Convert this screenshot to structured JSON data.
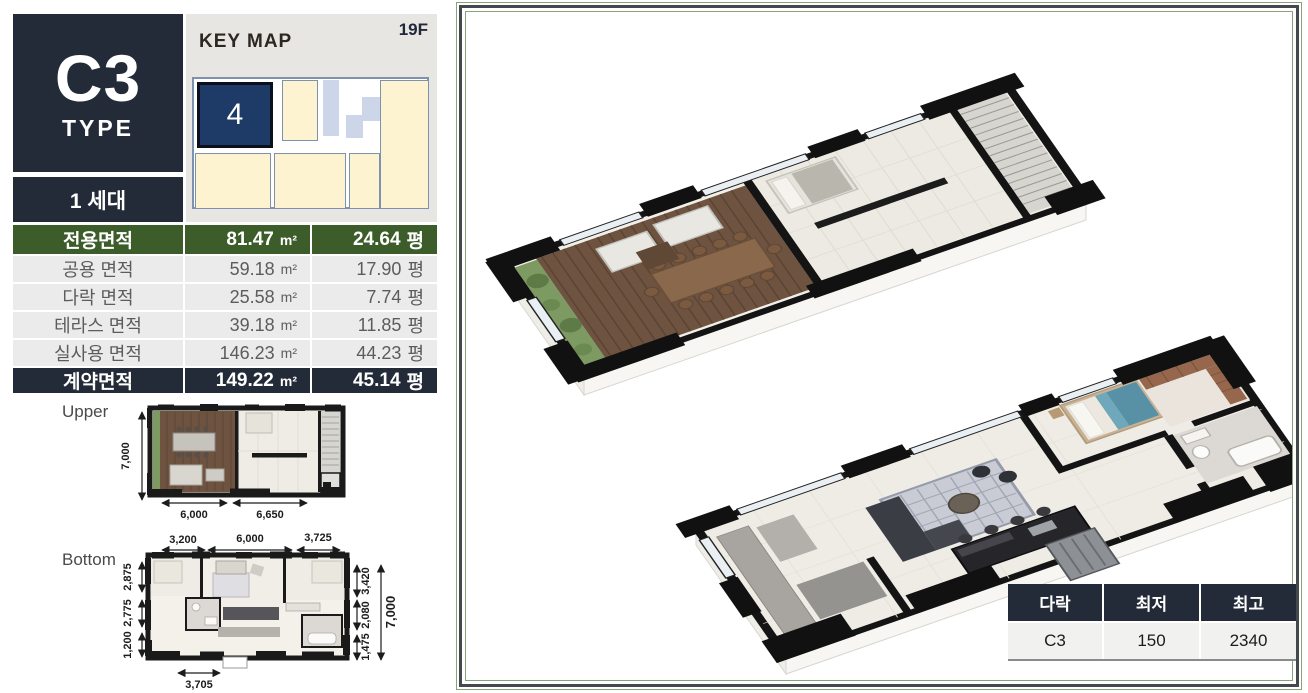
{
  "unit": {
    "type": "C3",
    "type_label": "TYPE",
    "household": "1 세대"
  },
  "keymap": {
    "title": "KEY MAP",
    "floor": "19F",
    "unit_number": "4"
  },
  "area_table": {
    "units": {
      "m2": "m²",
      "pyeong": "평"
    },
    "header": {
      "label": "전용면적",
      "m2": "81.47",
      "pyeong": "24.64"
    },
    "rows": [
      {
        "label": "공용 면적",
        "m2": "59.18",
        "pyeong": "17.90"
      },
      {
        "label": "다락 면적",
        "m2": "25.58",
        "pyeong": "7.74"
      },
      {
        "label": "테라스 면적",
        "m2": "39.18",
        "pyeong": "11.85"
      },
      {
        "label": "실사용 면적",
        "m2": "146.23",
        "pyeong": "44.23"
      }
    ],
    "footer": {
      "label": "계약면적",
      "m2": "149.22",
      "pyeong": "45.14"
    }
  },
  "plans": {
    "upper": {
      "label": "Upper",
      "dim_left": "7,000",
      "dim_bottom_left": "6,000",
      "dim_bottom_right": "6,650"
    },
    "bottom": {
      "label": "Bottom",
      "dim_top": [
        "3,200",
        "6,000",
        "3,725"
      ],
      "dim_left": [
        "2,875",
        "2,775",
        "1,200"
      ],
      "dim_right": [
        "3,420",
        "2,080",
        "1,475"
      ],
      "dim_right_total": "7,000",
      "dim_bottom": "3,705"
    }
  },
  "attic_table": {
    "headers": [
      "다락",
      "최저",
      "최고"
    ],
    "row": [
      "C3",
      "150",
      "2340"
    ]
  },
  "colors": {
    "navy": "#232b38",
    "green": "#3c5c2a",
    "keymap_unit_navy": "#1e3a66",
    "keymap_cream": "#fdf3d0",
    "keymap_border": "#7d93ad",
    "frame_green": "#86a478",
    "row_gray": "#ebebeb"
  }
}
